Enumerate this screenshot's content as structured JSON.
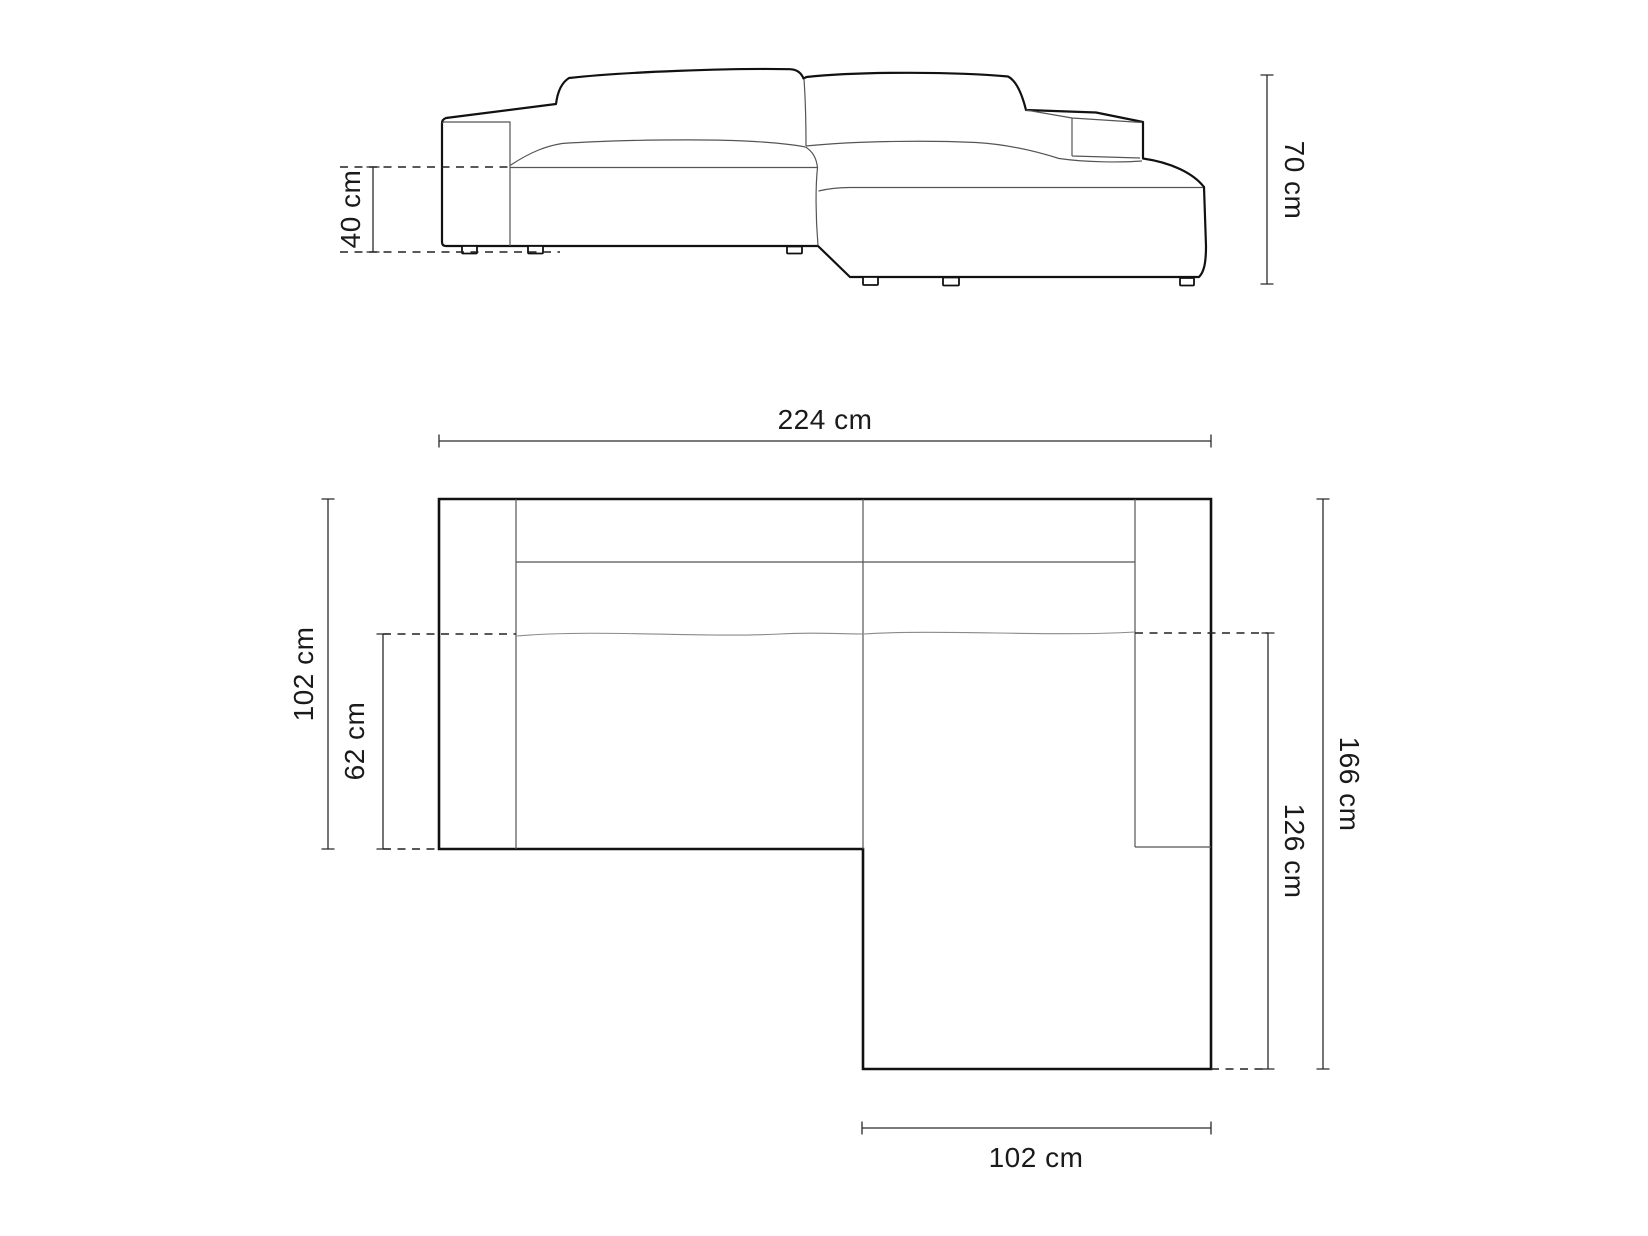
{
  "title": "Corner sofa dimensions diagram",
  "colors": {
    "background": "#ffffff",
    "outline": "#111111",
    "detail_line": "#555555",
    "soft_line": "#8a8a8a",
    "dashed_line": "#222222",
    "dimension": "#2a2a2a",
    "text": "#1a1a1a"
  },
  "elevation": {
    "seat_height_label": "40 cm",
    "total_height_label": "70 cm"
  },
  "plan": {
    "total_width_label": "224 cm",
    "left_depth_label": "102 cm",
    "seat_depth_label": "62 cm",
    "total_depth_label": "166 cm",
    "chaise_depth_label": "126 cm",
    "chaise_width_label": "102 cm"
  }
}
